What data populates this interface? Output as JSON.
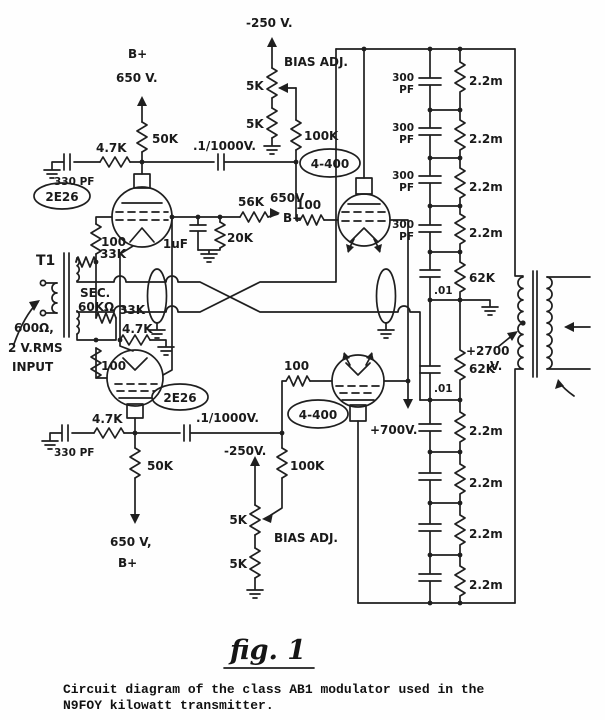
{
  "figure": {
    "fig_label": "fig. 1",
    "caption_line1": "Circuit diagram of the class AB1 modulator used in the",
    "caption_line2": "N9FOY kilowatt transmitter."
  },
  "labels": {
    "minus250_top": "-250 V.",
    "minus250_bot": "-250V.",
    "bias_adj": "BIAS ADJ.",
    "r5k": "5K",
    "r50k": "50K",
    "r47k": "4.7K",
    "r33k": "33K",
    "r100": "100",
    "r100k": "100K",
    "r22m": "2.2m",
    "r62k": "62K",
    "r56k": "56K",
    "r20k": "20K",
    "c330pf": "330 PF",
    "c300": "300",
    "pf": "PF",
    "c01": ".01",
    "c1uf": "1uF",
    "c_coupling": ".1/1000V.",
    "tube_2e26": "2E26",
    "tube_4400": "4-400",
    "bplus": "B+",
    "v650": "650 V.",
    "v650_mid": "650V",
    "bplus_mid": "B+",
    "v650_bot": "650 V,",
    "bplus_bot": "B+",
    "plus700": "+700V.",
    "plus2700": "+2700",
    "plus2700_v": "V.",
    "t1": "T1",
    "sec": "SEC.",
    "sec_z": "60KΩ",
    "in_600": "600Ω,",
    "in_2vrms": "2 V.RMS",
    "in_input": "INPUT"
  }
}
